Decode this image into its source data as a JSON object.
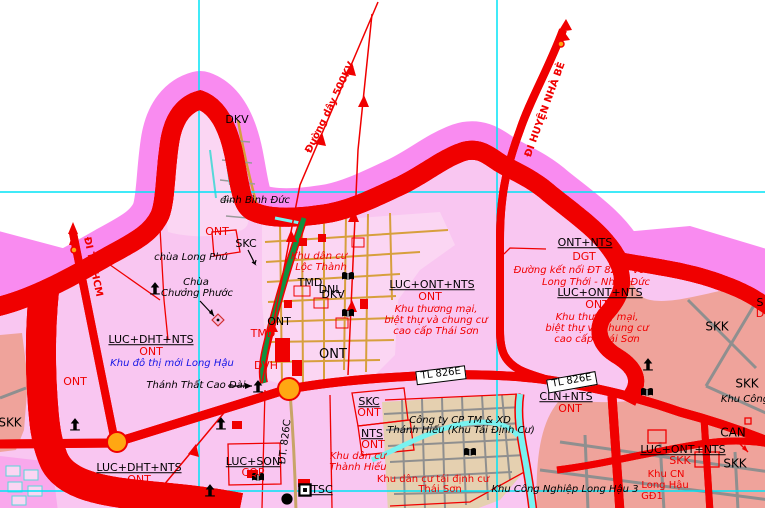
{
  "map_title": "Land-use planning map (Long Hậu area)",
  "colors": {
    "outer_band": "#f98bf0",
    "zone_pink": "#f9c6f1",
    "village_pink": "#fbd6f3",
    "industrial_salmon": "#efa39b",
    "resettlement_beige": "#e5d0b0",
    "river_cyan": "#78f2f0",
    "grid_cyan": "#00e4f6",
    "road_orange": "#ffa712",
    "road_red_casing": "#f00000",
    "green_road": "#0f9140",
    "street_tan": "#d79f3c",
    "road_gray": "#8f8f8f",
    "label_red": "#f00000",
    "label_blue": "#1515e6"
  },
  "grid": {
    "vertical_x": [
      199,
      497
    ],
    "horizontal_y": [
      192,
      491
    ]
  },
  "icons": [
    {
      "name": "pagoda-icon",
      "type": "pagoda",
      "x": 75,
      "y": 424
    },
    {
      "name": "pagoda-icon",
      "type": "pagoda",
      "x": 155,
      "y": 288
    },
    {
      "name": "pagoda-icon",
      "type": "pagoda",
      "x": 221,
      "y": 423
    },
    {
      "name": "pagoda-icon",
      "type": "pagoda",
      "x": 210,
      "y": 490
    },
    {
      "name": "pagoda-icon",
      "type": "pagoda",
      "x": 648,
      "y": 364
    },
    {
      "name": "cao-dai-temple-icon",
      "type": "pagoda",
      "x": 258,
      "y": 386
    },
    {
      "name": "school-book-icon",
      "type": "book",
      "x": 348,
      "y": 276
    },
    {
      "name": "school-book-icon",
      "type": "book",
      "x": 348,
      "y": 313
    },
    {
      "name": "school-book-icon",
      "type": "book",
      "x": 470,
      "y": 452
    },
    {
      "name": "school-book-icon",
      "type": "book",
      "x": 647,
      "y": 392
    },
    {
      "name": "school-book-icon",
      "type": "book",
      "x": 258,
      "y": 477
    },
    {
      "name": "building-square-icon",
      "type": "square",
      "x": 305,
      "y": 490
    },
    {
      "name": "poi-dot-icon",
      "type": "dot",
      "x": 287,
      "y": 499
    },
    {
      "name": "pagoda-diamond-icon",
      "type": "diamond",
      "x": 218,
      "y": 320
    }
  ],
  "labels": [
    {
      "name": "road-label-di-tp-hcm",
      "text": "ĐI TP. HCM",
      "x": 92,
      "y": 267,
      "rot": 78,
      "cls": "rd bold",
      "fs": 10
    },
    {
      "name": "road-label-di-huyen-nha-be",
      "text": "ĐI HUYỆN NHÀ BÈ",
      "x": 546,
      "y": 110,
      "rot": -70,
      "cls": "rd bold",
      "fs": 10
    },
    {
      "name": "power-line-label-500kv",
      "text": "Đường dây 500KV",
      "x": 331,
      "y": 108,
      "rot": -64,
      "cls": "rd bold",
      "fs": 10
    },
    {
      "name": "road-label-dt-826c",
      "text": "ĐT. 826C",
      "x": 286,
      "y": 442,
      "rot": -83,
      "cls": "bk",
      "fs": 10
    },
    {
      "name": "road-box-tl-826e-1",
      "text": "TL 826E",
      "x": 441,
      "y": 375,
      "rot": -7,
      "cls": "box",
      "fs": 10
    },
    {
      "name": "road-box-tl-826e-2",
      "text": "TL 826E",
      "x": 572,
      "y": 382,
      "rot": -10,
      "cls": "box",
      "fs": 10
    },
    {
      "name": "zone-code",
      "text": "LUC+ONT+NTS",
      "x": 432,
      "y": 285,
      "cls": "u",
      "fs": 11
    },
    {
      "name": "zone-code",
      "text": "ONT",
      "x": 430,
      "y": 297,
      "cls": "rd",
      "fs": 11
    },
    {
      "name": "zone-annotation",
      "text": "Khu thương mại,",
      "x": 436,
      "y": 310,
      "cls": "rd it",
      "fs": 10
    },
    {
      "name": "zone-annotation",
      "text": "biệt thự và chung cư",
      "x": 436,
      "y": 321,
      "cls": "rd it",
      "fs": 10
    },
    {
      "name": "zone-annotation",
      "text": "cao cấp Thái Sơn",
      "x": 436,
      "y": 332,
      "cls": "rd it",
      "fs": 10
    },
    {
      "name": "zone-code",
      "text": "LUC+ONT+NTS",
      "x": 600,
      "y": 293,
      "cls": "u",
      "fs": 11
    },
    {
      "name": "zone-code",
      "text": "ONT",
      "x": 597,
      "y": 305,
      "cls": "rd",
      "fs": 11
    },
    {
      "name": "zone-annotation",
      "text": "Khu thương mại,",
      "x": 597,
      "y": 318,
      "cls": "rd it",
      "fs": 10
    },
    {
      "name": "zone-annotation",
      "text": "biệt thự và chung cư",
      "x": 597,
      "y": 329,
      "cls": "rd it",
      "fs": 10
    },
    {
      "name": "zone-annotation",
      "text": "cao cấp Thái Sơn",
      "x": 597,
      "y": 340,
      "cls": "rd it",
      "fs": 10
    },
    {
      "name": "zone-code",
      "text": "ONT+NTS",
      "x": 585,
      "y": 243,
      "cls": "u",
      "fs": 11
    },
    {
      "name": "zone-code",
      "text": "DGT",
      "x": 584,
      "y": 257,
      "cls": "rd",
      "fs": 11
    },
    {
      "name": "road-annotation",
      "text": "Đường kết nối ĐT 826E với đường",
      "x": 598,
      "y": 271,
      "cls": "rd it",
      "fs": 10
    },
    {
      "name": "road-annotation",
      "text": "Long Thới - Nhơn Đức",
      "x": 596,
      "y": 283,
      "cls": "rd it",
      "fs": 10
    },
    {
      "name": "zone-code",
      "text": "LUC+DHT+NTS",
      "x": 151,
      "y": 340,
      "cls": "u",
      "fs": 11
    },
    {
      "name": "zone-code",
      "text": "ONT",
      "x": 151,
      "y": 352,
      "cls": "rd",
      "fs": 11
    },
    {
      "name": "zone-annotation",
      "text": "Khu đô thị mới Long Hậu",
      "x": 172,
      "y": 364,
      "cls": "bl it",
      "fs": 10
    },
    {
      "name": "zone-code",
      "text": "LUC+DHT+NTS",
      "x": 139,
      "y": 468,
      "cls": "u",
      "fs": 11
    },
    {
      "name": "zone-code",
      "text": "ONT",
      "x": 139,
      "y": 480,
      "cls": "rd",
      "fs": 11
    },
    {
      "name": "zone-code",
      "text": "LUC+SON",
      "x": 253,
      "y": 462,
      "cls": "u",
      "fs": 11
    },
    {
      "name": "zone-code",
      "text": "CQP",
      "x": 253,
      "y": 473,
      "cls": "rd",
      "fs": 11
    },
    {
      "name": "zone-code",
      "text": "SKC",
      "x": 369,
      "y": 402,
      "cls": "u",
      "fs": 11
    },
    {
      "name": "zone-code",
      "text": "ONT",
      "x": 369,
      "y": 413,
      "cls": "rd",
      "fs": 11
    },
    {
      "name": "zone-code",
      "text": "NTS",
      "x": 372,
      "y": 434,
      "cls": "u",
      "fs": 11
    },
    {
      "name": "zone-code",
      "text": "ONT",
      "x": 373,
      "y": 445,
      "cls": "rd",
      "fs": 11
    },
    {
      "name": "zone-annotation",
      "text": "Khu dân cư",
      "x": 358,
      "y": 457,
      "cls": "rd it",
      "fs": 10
    },
    {
      "name": "zone-annotation",
      "text": "Thành Hiếu",
      "x": 358,
      "y": 468,
      "cls": "rd it",
      "fs": 10
    },
    {
      "name": "zone-code",
      "text": "CLN+NTS",
      "x": 566,
      "y": 397,
      "cls": "u",
      "fs": 11
    },
    {
      "name": "zone-code",
      "text": "ONT",
      "x": 570,
      "y": 409,
      "cls": "rd",
      "fs": 11
    },
    {
      "name": "zone-code",
      "text": "LUC+ONT+NTS",
      "x": 683,
      "y": 450,
      "cls": "u",
      "fs": 11
    },
    {
      "name": "zone-code",
      "text": "SKK",
      "x": 680,
      "y": 461,
      "cls": "rd",
      "fs": 11
    },
    {
      "name": "zone-annotation",
      "text": "Khu CN",
      "x": 666,
      "y": 475,
      "cls": "rd",
      "fs": 10
    },
    {
      "name": "zone-annotation",
      "text": "Long Hậu",
      "x": 665,
      "y": 486,
      "cls": "rd",
      "fs": 10
    },
    {
      "name": "zone-annotation",
      "text": "GĐ1",
      "x": 652,
      "y": 497,
      "cls": "rd",
      "fs": 10
    },
    {
      "name": "zone-code",
      "text": "TSC",
      "x": 322,
      "y": 490,
      "cls": "u",
      "fs": 11
    },
    {
      "name": "zone-annotation",
      "text": "Khu dân cư",
      "x": 319,
      "y": 257,
      "cls": "rd it",
      "fs": 10
    },
    {
      "name": "zone-annotation",
      "text": "Lộc Thành",
      "x": 321,
      "y": 268,
      "cls": "rd it",
      "fs": 10
    },
    {
      "name": "zone-annotation",
      "text": "Khu dân cư tái định cư",
      "x": 433,
      "y": 480,
      "cls": "rd",
      "fs": 10
    },
    {
      "name": "zone-annotation",
      "text": "Thái Sơn",
      "x": 440,
      "y": 490,
      "cls": "rd",
      "fs": 10
    },
    {
      "name": "place-name",
      "text": "đình Bình Đức",
      "x": 255,
      "y": 201,
      "cls": "it",
      "fs": 10
    },
    {
      "name": "place-name",
      "text": "chùa Long Phú",
      "x": 191,
      "y": 258,
      "cls": "it",
      "fs": 10
    },
    {
      "name": "place-name",
      "text": "Chùa",
      "x": 196,
      "y": 283,
      "cls": "it",
      "fs": 10
    },
    {
      "name": "place-name",
      "text": "Chưởng Phước",
      "x": 197,
      "y": 294,
      "cls": "it",
      "fs": 10
    },
    {
      "name": "place-name",
      "text": "Thánh Thất Cao Đài",
      "x": 196,
      "y": 386,
      "cls": "it",
      "fs": 10
    },
    {
      "name": "place-name",
      "text": "Công ty CP TM & XD",
      "x": 460,
      "y": 421,
      "cls": "it",
      "fs": 10
    },
    {
      "name": "place-name",
      "text": "Thánh Hiếu (Khu Tái Định Cư)",
      "x": 461,
      "y": 431,
      "cls": "it",
      "fs": 10
    },
    {
      "name": "place-name",
      "text": "Khu Công Nghiệp Long Hậu 3",
      "x": 565,
      "y": 490,
      "cls": "it",
      "fs": 10
    },
    {
      "name": "place-name",
      "text": "Khu Công",
      "x": 745,
      "y": 400,
      "cls": "it",
      "fs": 10
    },
    {
      "name": "zone-code",
      "text": "DKV",
      "x": 237,
      "y": 120,
      "cls": "bk",
      "fs": 11
    },
    {
      "name": "zone-code",
      "text": "ONT",
      "x": 217,
      "y": 232,
      "cls": "rd",
      "fs": 11
    },
    {
      "name": "zone-code",
      "text": "SKC",
      "x": 246,
      "y": 244,
      "cls": "bk",
      "fs": 11
    },
    {
      "name": "zone-code",
      "text": "DNL",
      "x": 330,
      "y": 290,
      "cls": "bk",
      "fs": 11
    },
    {
      "name": "zone-code",
      "text": "TMD",
      "x": 310,
      "y": 283,
      "cls": "bk",
      "fs": 11
    },
    {
      "name": "zone-code",
      "text": "DKV",
      "x": 333,
      "y": 295,
      "cls": "bk",
      "fs": 11
    },
    {
      "name": "zone-code",
      "text": "ONT",
      "x": 279,
      "y": 322,
      "cls": "bk",
      "fs": 11
    },
    {
      "name": "zone-code",
      "text": "ONT",
      "x": 333,
      "y": 355,
      "cls": "bk",
      "fs": 13
    },
    {
      "name": "zone-code",
      "text": "TMD",
      "x": 263,
      "y": 334,
      "cls": "rd",
      "fs": 11
    },
    {
      "name": "zone-code",
      "text": "DVH",
      "x": 266,
      "y": 366,
      "cls": "rd",
      "fs": 11
    },
    {
      "name": "zone-code",
      "text": "ONT",
      "x": 75,
      "y": 382,
      "cls": "rd",
      "fs": 11
    },
    {
      "name": "zone-code",
      "text": "SKK",
      "x": 717,
      "y": 327,
      "cls": "bk",
      "fs": 12
    },
    {
      "name": "zone-code",
      "text": "SKK",
      "x": 747,
      "y": 384,
      "cls": "bk",
      "fs": 12
    },
    {
      "name": "zone-code",
      "text": "SKK",
      "x": 735,
      "y": 464,
      "cls": "bk",
      "fs": 12
    },
    {
      "name": "zone-code",
      "text": "CAN",
      "x": 733,
      "y": 433,
      "cls": "bk",
      "fs": 12
    },
    {
      "name": "zone-code",
      "text": "SKK",
      "x": 10,
      "y": 423,
      "cls": "bk",
      "fs": 12
    },
    {
      "name": "zone-code",
      "text": "S",
      "x": 760,
      "y": 303,
      "cls": "bk",
      "fs": 11
    },
    {
      "name": "zone-code",
      "text": "D",
      "x": 760,
      "y": 314,
      "cls": "rd",
      "fs": 11
    }
  ]
}
